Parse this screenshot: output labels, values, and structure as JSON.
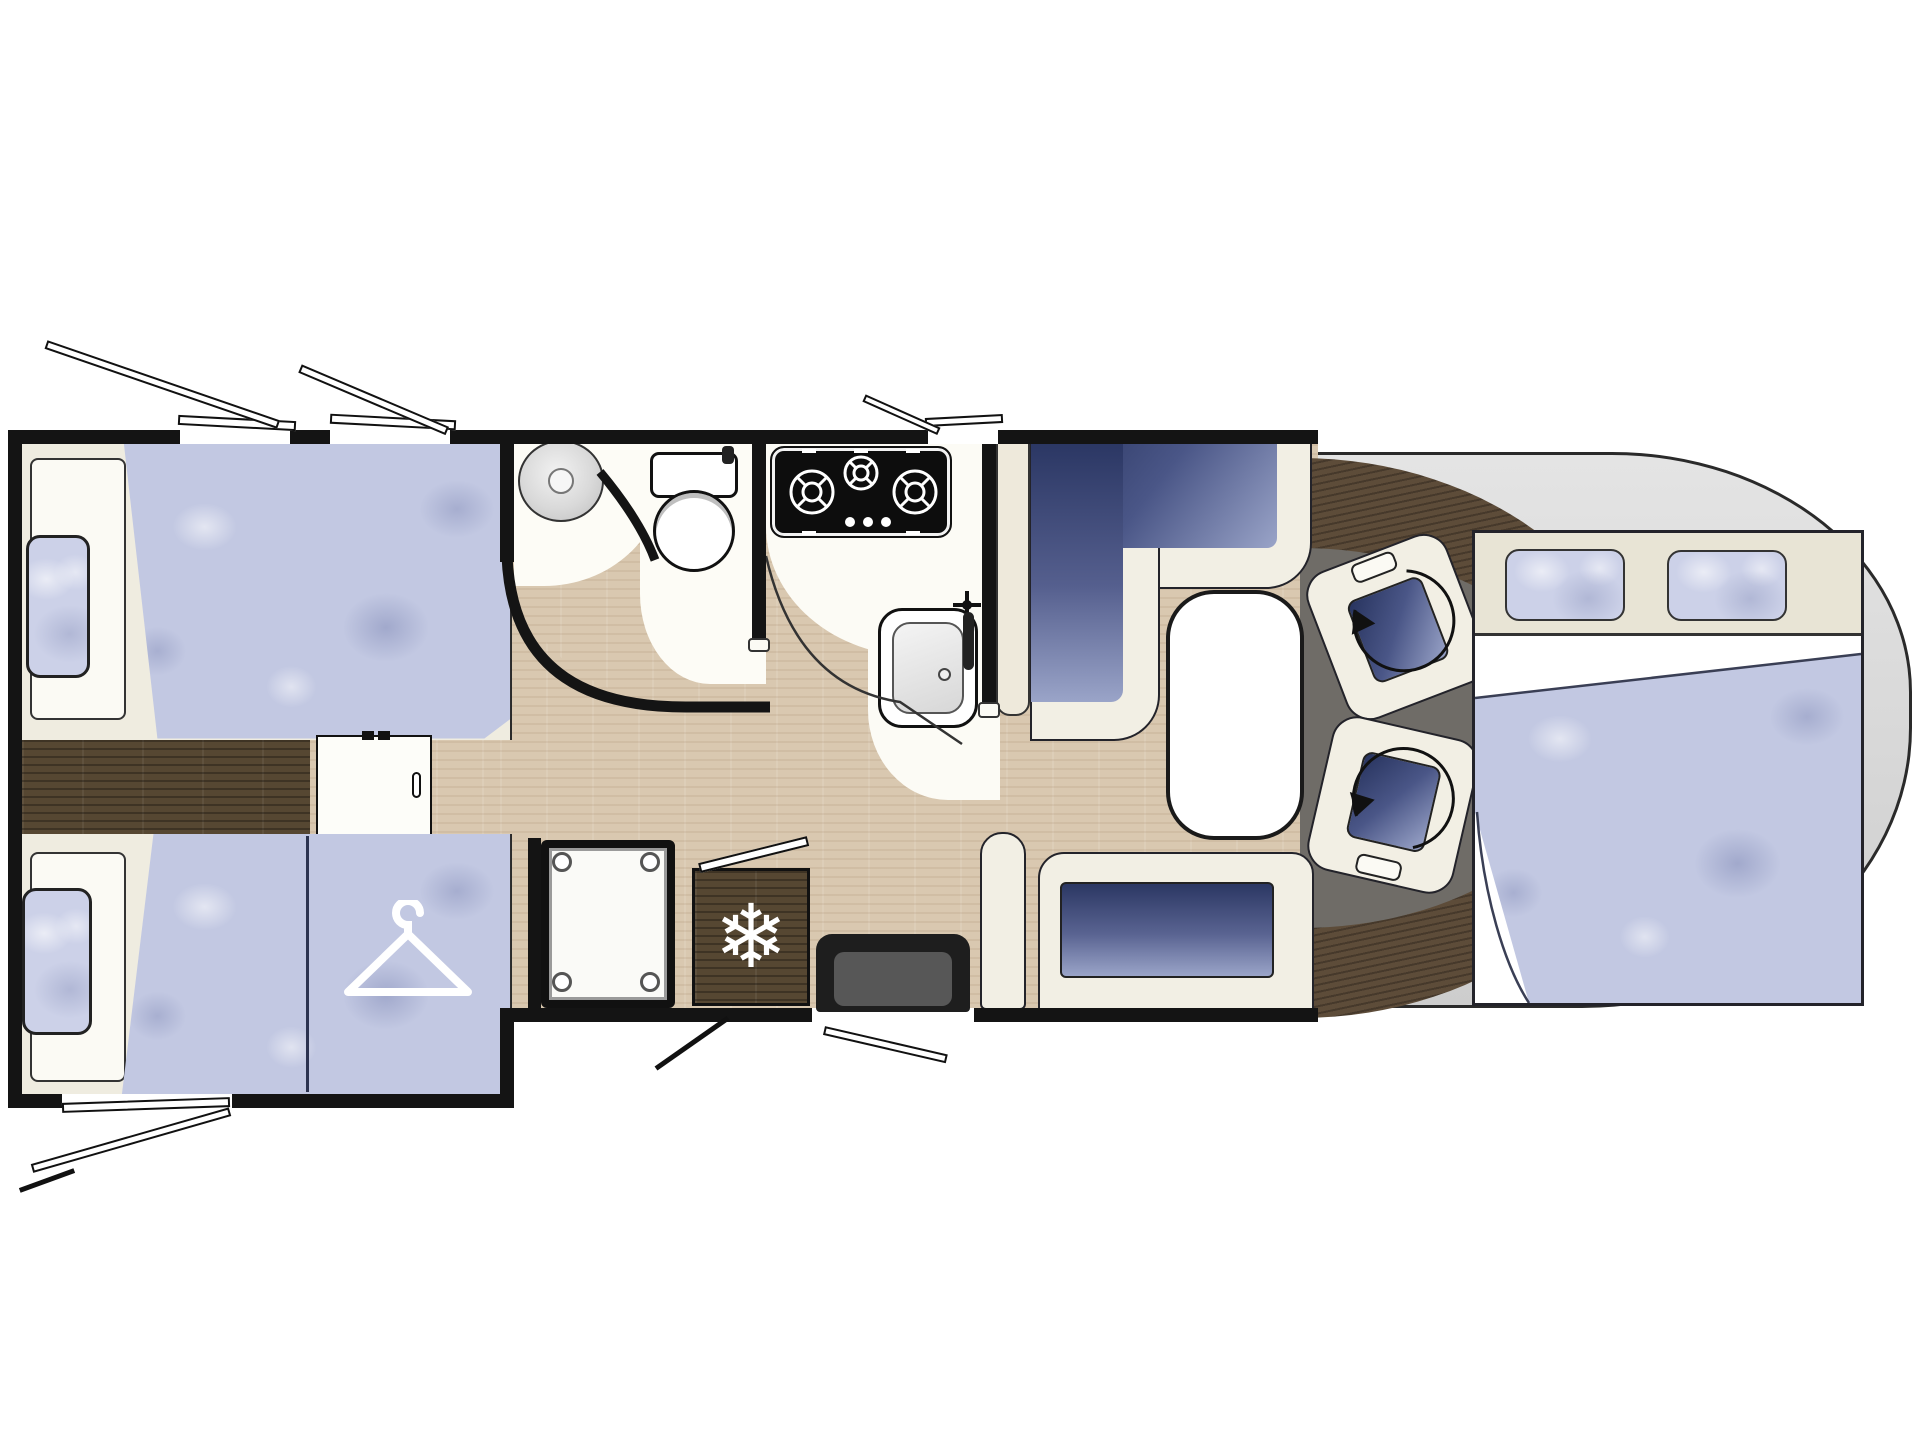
{
  "meta": {
    "title": "Motorhome floor plan (top view, cab at right)",
    "diagram_type": "vehicle-floor-plan",
    "text_content": "none — drawing contains no written text"
  },
  "colors": {
    "wall": "#141414",
    "light_wood_floor": "#d9c8b0",
    "dark_wood": "#564732",
    "upholstery_blue_dark": "#3a4675",
    "upholstery_blue_light": "#c2c8e2",
    "furniture_cream": "#f2efe4",
    "cab_floor_gray": "#6f6c67",
    "body_gray": "#dcdcdc"
  },
  "icons": {
    "snowflake_glyph": "❄",
    "hanger": "clothes-hanger-icon",
    "swivel_arrow": "rotation-arrow-icon",
    "faucet_cross": "faucet-cross-icon"
  },
  "rooms": {
    "rear_bedroom": {
      "name": "Rear bedroom",
      "features": [
        "twin single bed top",
        "twin single bed bottom",
        "wardrobe with hanger symbol",
        "sliding privacy door",
        "dark wood step floor",
        "two rear side windows",
        "two opening windows top wall",
        "one opening window bottom wall"
      ]
    },
    "bathroom": {
      "name": "Washroom",
      "features": [
        "round wash basin",
        "toilet",
        "curved partition wall",
        "wood floor"
      ]
    },
    "shower": {
      "name": "Shower cubicle",
      "features": [
        "square tray with corner fittings"
      ]
    },
    "kitchen": {
      "name": "Kitchen",
      "features": [
        "3-burner gas hob",
        "sink with faucet",
        "curved worktop",
        "opening window"
      ]
    },
    "fridge": {
      "name": "Refrigerator",
      "symbol": "snowflake"
    },
    "entrance": {
      "name": "Entry door with step",
      "features": [
        "door swing marks outside"
      ]
    },
    "lounge": {
      "name": "L-shaped dinette",
      "features": [
        "L-shaped bench seat",
        "oval pedestal table",
        "side sofa bench under window"
      ]
    },
    "cab": {
      "name": "Driver cab",
      "features": [
        "two swivel captain seats with rotation arrows",
        "curved dashboard",
        "gray cab mat",
        "rounded body nose"
      ]
    },
    "front_bed": {
      "name": "Drop-down double bed over cab",
      "features": [
        "two pillows",
        "white sheet fold",
        "large quilted mattress overlapping cab"
      ]
    }
  }
}
